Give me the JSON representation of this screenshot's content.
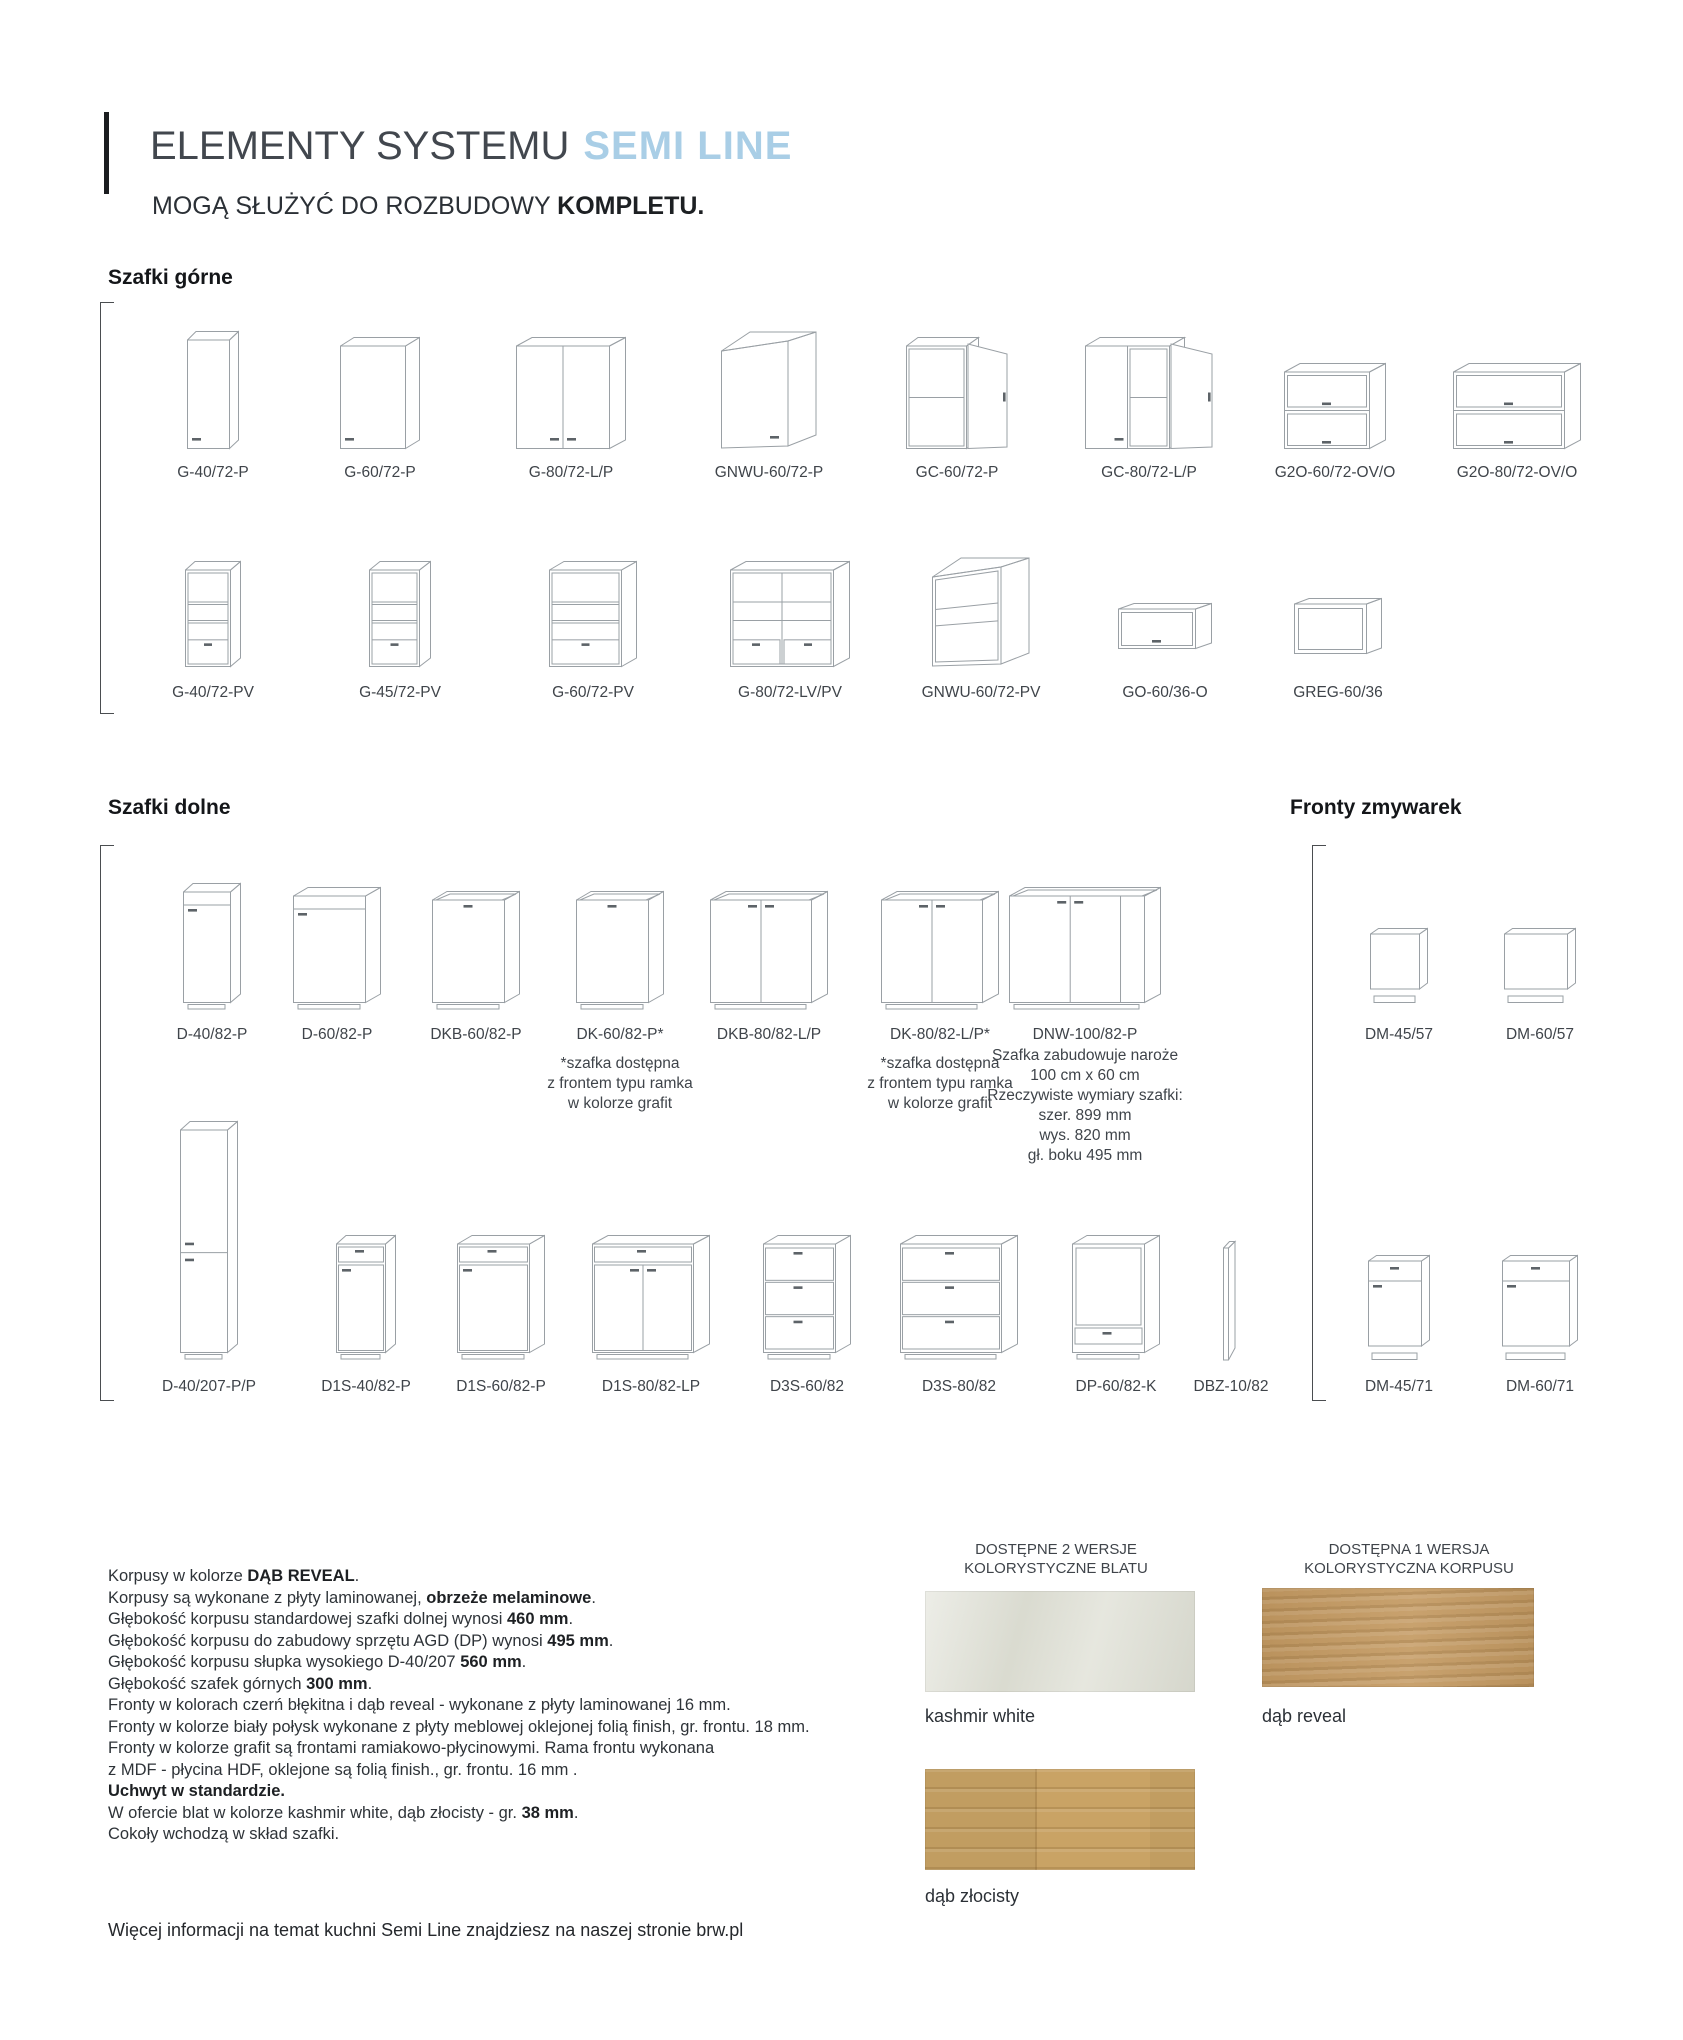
{
  "header": {
    "title_main": "ELEMENTY SYSTEMU",
    "title_accent": "SEMI LINE",
    "subtitle_prefix": "MOGĄ SŁUŻYĆ DO ROZBUDOWY",
    "subtitle_bold": "KOMPLETU.",
    "accent_color": "#a9cee6"
  },
  "sections": {
    "upper": {
      "heading": "Szafki górne",
      "rows": [
        [
          {
            "label": "G-40/72-P",
            "icon": "upper-cabinet-single-door"
          },
          {
            "label": "G-60/72-P",
            "icon": "upper-cabinet-single-door"
          },
          {
            "label": "G-80/72-L/P",
            "icon": "upper-cabinet-double-door"
          },
          {
            "label": "GNWU-60/72-P",
            "icon": "upper-cabinet-corner"
          },
          {
            "label": "GC-60/72-P",
            "icon": "upper-cabinet-open-door"
          },
          {
            "label": "GC-80/72-L/P",
            "icon": "upper-cabinet-double-open-door"
          },
          {
            "label": "G2O-60/72-OV/O",
            "icon": "upper-cabinet-flip-double"
          },
          {
            "label": "G2O-80/72-OV/O",
            "icon": "upper-cabinet-flip-double"
          }
        ],
        [
          {
            "label": "G-40/72-PV",
            "icon": "upper-cabinet-open-shelves"
          },
          {
            "label": "G-45/72-PV",
            "icon": "upper-cabinet-open-shelves"
          },
          {
            "label": "G-60/72-PV",
            "icon": "upper-cabinet-open-shelves"
          },
          {
            "label": "G-80/72-LV/PV",
            "icon": "upper-cabinet-open-shelves-wide"
          },
          {
            "label": "GNWU-60/72-PV",
            "icon": "upper-cabinet-corner-open"
          },
          {
            "label": "GO-60/36-O",
            "icon": "upper-cabinet-flip-door"
          },
          {
            "label": "GREG-60/36",
            "icon": "upper-cabinet-open-box"
          }
        ]
      ]
    },
    "lower": {
      "heading": "Szafki dolne",
      "rows": [
        [
          {
            "label": "D-40/82-P",
            "icon": "base-cabinet-door"
          },
          {
            "label": "D-60/82-P",
            "icon": "base-cabinet-door"
          },
          {
            "label": "DKB-60/82-P",
            "icon": "base-cabinet-sink"
          },
          {
            "label": "DK-60/82-P*",
            "icon": "base-cabinet-sink",
            "note": true
          },
          {
            "label": "DKB-80/82-L/P",
            "icon": "base-cabinet-sink-double"
          },
          {
            "label": "DK-80/82-L/P*",
            "icon": "base-cabinet-sink-double",
            "note": true
          },
          {
            "label": "DNW-100/82-P",
            "icon": "base-cabinet-corner",
            "desc": true
          }
        ],
        [
          {
            "label": "D-40/207-P/P",
            "icon": "tall-cabinet"
          },
          {
            "label": "D1S-40/82-P",
            "icon": "base-cabinet-drawer-door"
          },
          {
            "label": "D1S-60/82-P",
            "icon": "base-cabinet-drawer-door"
          },
          {
            "label": "D1S-80/82-LP",
            "icon": "base-cabinet-drawer-double-door"
          },
          {
            "label": "D3S-60/82",
            "icon": "base-cabinet-three-drawers"
          },
          {
            "label": "D3S-80/82",
            "icon": "base-cabinet-three-drawers"
          },
          {
            "label": "DP-60/82-K",
            "icon": "base-cabinet-oven"
          },
          {
            "label": "DBZ-10/82",
            "icon": "filler-strip"
          }
        ]
      ],
      "notes": {
        "asterisk": [
          "*szafka dostępna",
          "z frontem typu ramka",
          "w kolorze grafit"
        ],
        "dnw_lines": [
          "Szafka zabudowuje naroże",
          "100 cm x 60 cm",
          "Rzeczywiste wymiary szafki:",
          "szer. 899 mm",
          "wys. 820 mm",
          "gł. boku 495 mm"
        ]
      }
    },
    "dishwasher": {
      "heading": "Fronty zmywarek",
      "rows": [
        [
          {
            "label": "DM-45/57",
            "icon": "dishwasher-panel"
          },
          {
            "label": "DM-60/57",
            "icon": "dishwasher-panel"
          }
        ],
        [
          {
            "label": "DM-45/71",
            "icon": "dishwasher-panel-drawer"
          },
          {
            "label": "DM-60/71",
            "icon": "dishwasher-panel-drawer"
          }
        ]
      ]
    }
  },
  "specs": {
    "lines": [
      [
        {
          "t": "Korpusy w kolorze "
        },
        {
          "t": "DĄB REVEAL",
          "b": true
        },
        {
          "t": "."
        }
      ],
      [
        {
          "t": "Korpusy są wykonane z płyty laminowanej, "
        },
        {
          "t": "obrzeże melaminowe",
          "b": true
        },
        {
          "t": "."
        }
      ],
      [
        {
          "t": "Głębokość korpusu standardowej szafki dolnej wynosi "
        },
        {
          "t": "460 mm",
          "b": true
        },
        {
          "t": "."
        }
      ],
      [
        {
          "t": "Głębokość korpusu do zabudowy sprzętu AGD (DP) wynosi "
        },
        {
          "t": "495 mm",
          "b": true
        },
        {
          "t": "."
        }
      ],
      [
        {
          "t": "Głębokość korpusu słupka wysokiego D-40/207 "
        },
        {
          "t": "560 mm",
          "b": true
        },
        {
          "t": "."
        }
      ],
      [
        {
          "t": "Głębokość szafek górnych "
        },
        {
          "t": "300 mm",
          "b": true
        },
        {
          "t": "."
        }
      ],
      [
        {
          "t": "Fronty w kolorach czerń błękitna i dąb reveal - wykonane z płyty laminowanej 16 mm."
        }
      ],
      [
        {
          "t": "Fronty w kolorze biały połysk wykonane z płyty meblowej oklejonej folią finish, gr. frontu. 18 mm."
        }
      ],
      [
        {
          "t": "Fronty w kolorze grafit są frontami ramiakowo-płycinowymi. Rama frontu wykonana"
        }
      ],
      [
        {
          "t": "z MDF - płycina HDF, oklejone są folią finish., gr. frontu. 16 mm ."
        }
      ],
      [
        {
          "t": "Uchwyt w standardzie.",
          "b": true
        }
      ],
      [
        {
          "t": "W ofercie blat w kolorze kashmir white, dąb złocisty - gr. "
        },
        {
          "t": "38 mm",
          "b": true
        },
        {
          "t": "."
        }
      ],
      [
        {
          "t": "Cokoły wchodzą w skład szafki."
        }
      ]
    ]
  },
  "finishes": {
    "worktop": {
      "heading_lines": [
        "DOSTĘPNE 2 WERSJE",
        "KOLORYSTYCZNE BLATU"
      ],
      "swatches": [
        {
          "name": "kashmir white",
          "color": "#dedfd4",
          "texture": "stone"
        },
        {
          "name": "dąb złocisty",
          "color": "#c9a365",
          "texture": "wood-planks"
        }
      ]
    },
    "carcass": {
      "heading_lines": [
        "DOSTĘPNA 1 WERSJA",
        "KOLORYSTYCZNA KORPUSU"
      ],
      "swatches": [
        {
          "name": "dąb reveal",
          "color": "#c49a62",
          "texture": "wood-grain"
        }
      ]
    }
  },
  "footer": {
    "text": "Więcej informacji na temat kuchni Semi Line znajdziesz na naszej stronie brw.pl"
  }
}
